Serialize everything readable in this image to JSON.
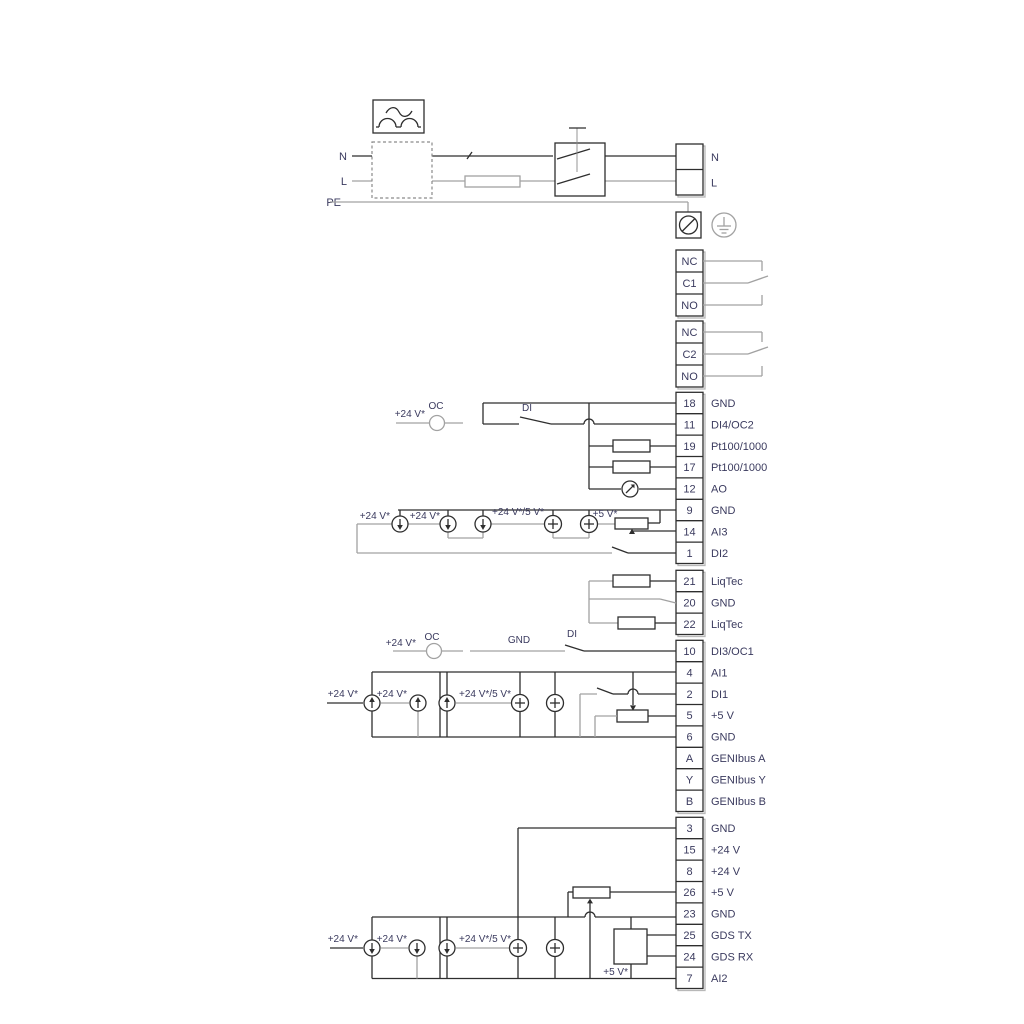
{
  "page": {
    "background": "#ffffff"
  },
  "colors": {
    "wire_dark": "#2e2e2e",
    "wire_gray": "#a2a2a2",
    "box_shadow": "#b8b8b8",
    "text": "#3a3a5e"
  },
  "mains": {
    "in": [
      "N",
      "L"
    ],
    "pe": "PE",
    "out": [
      "N",
      "L"
    ]
  },
  "relays": {
    "relay1": [
      "NC",
      "C1",
      "NO"
    ],
    "relay2": [
      "NC",
      "C2",
      "NO"
    ]
  },
  "terminals": {
    "group1": [
      [
        "18",
        "GND"
      ],
      [
        "11",
        "DI4/OC2"
      ],
      [
        "19",
        "Pt100/1000"
      ],
      [
        "17",
        "Pt100/1000"
      ],
      [
        "12",
        "AO"
      ],
      [
        "9",
        "GND"
      ],
      [
        "14",
        "AI3"
      ],
      [
        "1",
        "DI2"
      ]
    ],
    "group2": [
      [
        "21",
        "LiqTec"
      ],
      [
        "20",
        "GND"
      ],
      [
        "22",
        "LiqTec"
      ]
    ],
    "group3": [
      [
        "10",
        "DI3/OC1"
      ],
      [
        "4",
        "AI1"
      ],
      [
        "2",
        "DI1"
      ],
      [
        "5",
        "+5 V"
      ],
      [
        "6",
        "GND"
      ],
      [
        "A",
        "GENIbus A"
      ],
      [
        "Y",
        "GENIbus Y"
      ],
      [
        "B",
        "GENIbus B"
      ]
    ],
    "group4": [
      [
        "3",
        "GND"
      ],
      [
        "15",
        "+24 V"
      ],
      [
        "8",
        "+24 V"
      ],
      [
        "26",
        "+5 V"
      ],
      [
        "23",
        "GND"
      ],
      [
        "25",
        "GDS TX"
      ],
      [
        "24",
        "GDS RX"
      ],
      [
        "7",
        "AI2"
      ]
    ]
  },
  "ann": {
    "v24": "+24 V*",
    "v24_5": "+24 V*/5 V*",
    "v5": "+5 V*",
    "oc": "OC",
    "di": "DI",
    "gnd": "GND"
  }
}
